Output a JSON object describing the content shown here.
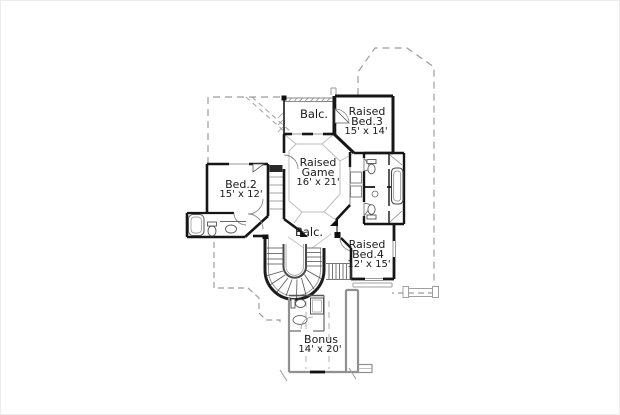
{
  "page": {
    "background": "#ffffff",
    "border_color": "#ececec"
  },
  "plan": {
    "type": "second-floor house plan drawing",
    "palette": {
      "wall": "#161616",
      "roofline_dash": "#9c9c9c",
      "ceiling_line": "#bcbcbc",
      "bonus_wall": "#909090",
      "fixture_line": "#555555",
      "text": "#1b1b1b"
    },
    "rooms": {
      "balcony_top": {
        "label": "Balc."
      },
      "raised_bed3": {
        "line1": "Raised",
        "line2": "Bed.3",
        "dims": "15' x 14'"
      },
      "raised_game": {
        "line1": "Raised",
        "line2": "Game",
        "dims": "16' x 21'"
      },
      "bed2": {
        "line1": "Bed.2",
        "dims": "15' x 12'"
      },
      "balcony_bottom": {
        "label": "Balc."
      },
      "raised_bed4": {
        "line1": "Raised",
        "line2": "Bed.4",
        "dims": "12' x 15'"
      },
      "bonus": {
        "line1": "Bonus",
        "dims": "14' x 20'"
      }
    }
  }
}
